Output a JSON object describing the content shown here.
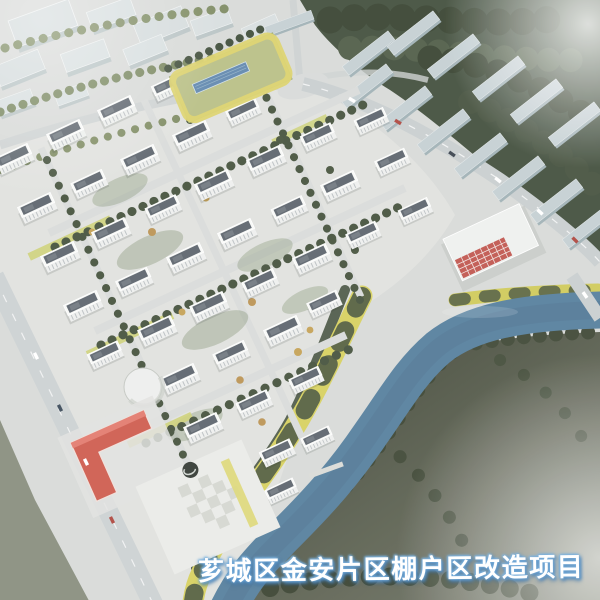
{
  "caption": {
    "text": "芗城区金安片区棚户区改造项目"
  },
  "palette": {
    "ground": "#d6d9d6",
    "estate_ground": "#e0e2de",
    "road": "#cbd0d1",
    "water": "#527fa0",
    "riverside_path": "#d6d055",
    "tower_body": "#edefed",
    "tower_roof": "#5c646d",
    "tree_dark": "#3f4d39",
    "tree_autumn": "#bd924d",
    "school_podium": "#b8bf80",
    "track_band": "#ddd263",
    "pool": "#5d87b2",
    "kindergarten_roof": "#d5594a",
    "red_facade": "#c7544c",
    "context_slab": "#c2ced2",
    "forest": "#414f3c",
    "southeast_land_near": "#494e3d",
    "southeast_land_far": "#757a6a",
    "plaza": "#e9eae6",
    "caption_fill": "#ffffff",
    "caption_glow": "#6fa7d7"
  }
}
